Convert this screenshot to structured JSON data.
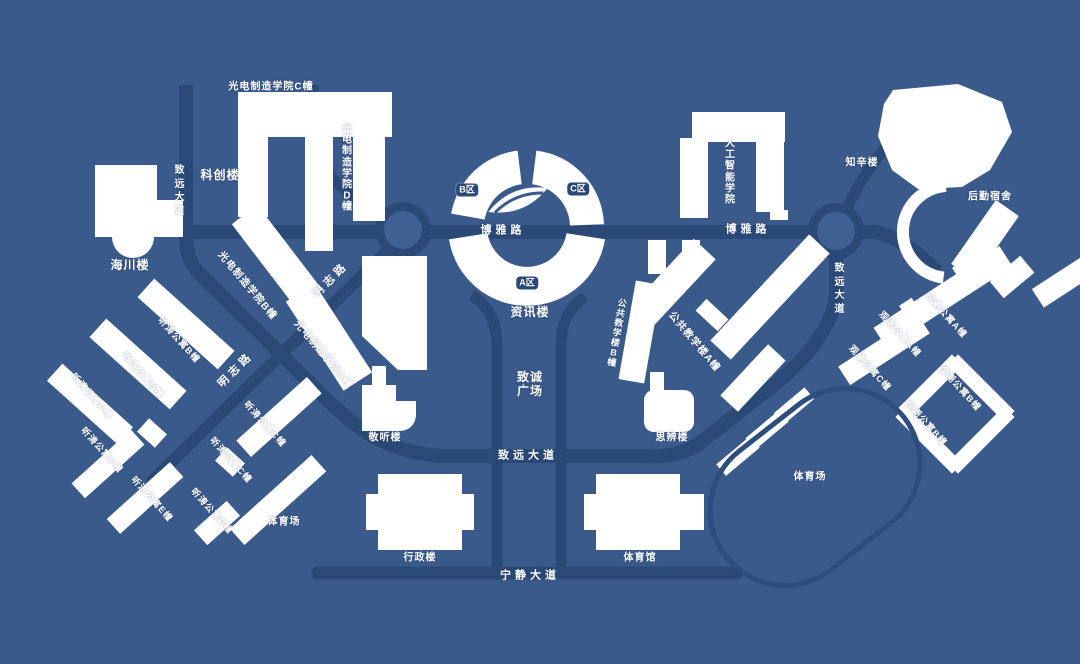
{
  "map": {
    "colors": {
      "background": "#3b5a8c",
      "road": "#2b4977",
      "roundabout_center": "#3e6093",
      "building": "#ffffff",
      "track_outline": "#2d4d7d",
      "label_text": "#ffffff",
      "zone_badge_bg": "#2b4977"
    },
    "labels": [
      {
        "id": "guangdian-c",
        "text": "光电制造学院C幢",
        "x": 271,
        "y": 87,
        "kind": "building"
      },
      {
        "id": "guangdian-d",
        "text": "光电制造学院D幢",
        "x": 347,
        "y": 168,
        "kind": "building-vertical"
      },
      {
        "id": "kechuang",
        "text": "科创楼",
        "x": 220,
        "y": 176,
        "kind": "building",
        "size": 12
      },
      {
        "id": "zhiyuan-dadao-left",
        "text": "致远大道",
        "x": 180,
        "y": 191,
        "kind": "road-vertical"
      },
      {
        "id": "haichuan",
        "text": "海川楼",
        "x": 130,
        "y": 266,
        "kind": "building",
        "size": 12
      },
      {
        "id": "guangdian-b",
        "text": "光电制造学院B幢",
        "x": 247,
        "y": 286,
        "kind": "building",
        "rot": 50
      },
      {
        "id": "mingzhi-lu-1",
        "text": "明志路",
        "x": 331,
        "y": 280,
        "kind": "road",
        "rot": -45
      },
      {
        "id": "mingzhi-lu-2",
        "text": "明志路",
        "x": 236,
        "y": 370,
        "kind": "road",
        "rot": -45
      },
      {
        "id": "guangdian-a",
        "text": "光电制造学院A幢",
        "x": 323,
        "y": 355,
        "kind": "building",
        "rot": 50
      },
      {
        "id": "jingting",
        "text": "敬听楼",
        "x": 385,
        "y": 438,
        "kind": "building"
      },
      {
        "id": "boya-lu-1",
        "text": "博雅路",
        "x": 503,
        "y": 231,
        "kind": "road"
      },
      {
        "id": "boya-lu-2",
        "text": "博雅路",
        "x": 748,
        "y": 230,
        "kind": "road"
      },
      {
        "id": "zone-b",
        "text": "B区",
        "x": 467,
        "y": 190,
        "kind": "badge"
      },
      {
        "id": "zone-c",
        "text": "C区",
        "x": 578,
        "y": 189,
        "kind": "badge"
      },
      {
        "id": "zone-a",
        "text": "A区",
        "x": 527,
        "y": 283,
        "kind": "badge"
      },
      {
        "id": "zixun",
        "text": "资讯楼",
        "x": 530,
        "y": 313,
        "kind": "building",
        "size": 12
      },
      {
        "id": "rengong-zhineng",
        "text": "人工智能学院",
        "x": 730,
        "y": 172,
        "kind": "building-vertical"
      },
      {
        "id": "zhixin",
        "text": "知辛楼",
        "x": 862,
        "y": 163,
        "kind": "building"
      },
      {
        "id": "houqin-sushe",
        "text": "后勤宿舍",
        "x": 990,
        "y": 197,
        "kind": "building"
      },
      {
        "id": "zhiyuan-dadao-right",
        "text": "致远大道",
        "x": 840,
        "y": 289,
        "kind": "road-vertical"
      },
      {
        "id": "gongjiao-b",
        "text": "公共教学楼B幢",
        "x": 617,
        "y": 333,
        "kind": "building-vertical",
        "rot": 10,
        "size": 9
      },
      {
        "id": "gongjiao-a",
        "text": "公共教学楼A幢",
        "x": 694,
        "y": 342,
        "kind": "building",
        "rot": 50
      },
      {
        "id": "zhicheng-guangchang",
        "text": "致诚\n广场",
        "x": 530,
        "y": 385,
        "kind": "building",
        "size": 12
      },
      {
        "id": "sibian",
        "text": "思辨楼",
        "x": 672,
        "y": 438,
        "kind": "building"
      },
      {
        "id": "zhiyuan-dadao-center",
        "text": "致远大道",
        "x": 528,
        "y": 456,
        "kind": "road"
      },
      {
        "id": "tingtao-b1",
        "text": "听涛公寓B幢",
        "x": 179,
        "y": 340,
        "kind": "building",
        "rot": 48,
        "size": 9
      },
      {
        "id": "tingtao-b2",
        "text": "听涛公寓B幢",
        "x": 143,
        "y": 375,
        "kind": "building",
        "rot": 48,
        "size": 9
      },
      {
        "id": "tingtao-a1",
        "text": "听涛公寓A幢",
        "x": 92,
        "y": 396,
        "kind": "building",
        "rot": 48,
        "size": 9
      },
      {
        "id": "tingtao-a2",
        "text": "听涛公寓A幢",
        "x": 102,
        "y": 450,
        "kind": "building",
        "rot": 48,
        "size": 9
      },
      {
        "id": "tingtao-e",
        "text": "听涛公寓E幢",
        "x": 152,
        "y": 499,
        "kind": "building",
        "rot": 48,
        "size": 9
      },
      {
        "id": "tingtao-d",
        "text": "听涛公寓D幢",
        "x": 212,
        "y": 511,
        "kind": "building",
        "rot": 48,
        "size": 9
      },
      {
        "id": "tingtao-c1",
        "text": "听涛公寓C幢",
        "x": 265,
        "y": 424,
        "kind": "building",
        "rot": 48,
        "size": 9
      },
      {
        "id": "tingtao-c2",
        "text": "听涛公寓C幢",
        "x": 231,
        "y": 460,
        "kind": "building",
        "rot": 48,
        "size": 9
      },
      {
        "id": "tiyuchang-left",
        "text": "体育场",
        "x": 284,
        "y": 522,
        "kind": "building"
      },
      {
        "id": "xingzheng",
        "text": "行政楼",
        "x": 420,
        "y": 558,
        "kind": "building"
      },
      {
        "id": "tiyuguan",
        "text": "体育馆",
        "x": 640,
        "y": 558,
        "kind": "building"
      },
      {
        "id": "ningjing-dadao",
        "text": "宁静大道",
        "x": 530,
        "y": 576,
        "kind": "road"
      },
      {
        "id": "tiyuchang-right",
        "text": "体育场",
        "x": 810,
        "y": 477,
        "kind": "building"
      },
      {
        "id": "guanchao-a1",
        "text": "观潮公寓A幢",
        "x": 946,
        "y": 315,
        "kind": "building",
        "rot": 48,
        "size": 9
      },
      {
        "id": "guanchao-a2",
        "text": "观潮公寓A幢",
        "x": 900,
        "y": 334,
        "kind": "building",
        "rot": 48,
        "size": 9
      },
      {
        "id": "guanchao-c",
        "text": "观潮公寓C幢",
        "x": 870,
        "y": 368,
        "kind": "building",
        "rot": 48,
        "size": 9
      },
      {
        "id": "guanchao-b1",
        "text": "观潮公寓B幢",
        "x": 960,
        "y": 388,
        "kind": "building",
        "rot": 48,
        "size": 9
      },
      {
        "id": "guanchao-b2",
        "text": "观潮公寓B幢",
        "x": 926,
        "y": 423,
        "kind": "building",
        "rot": 48,
        "size": 9
      }
    ]
  }
}
